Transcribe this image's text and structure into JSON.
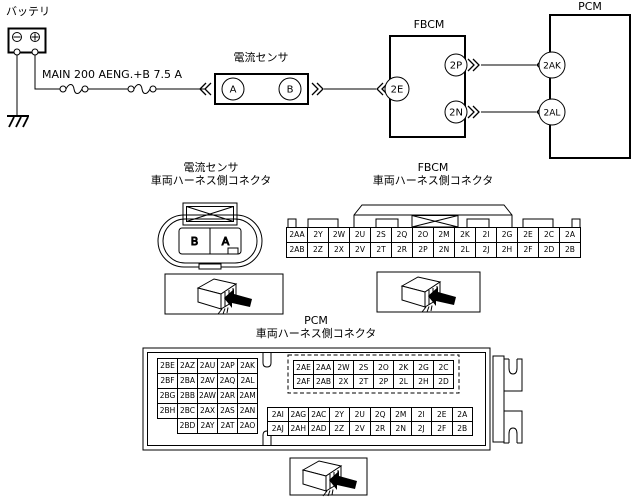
{
  "schematic": {
    "battery_label": "バッテリ",
    "fuse1_label": "MAIN 200 A",
    "fuse2_label": "ENG.+B 7.5 A",
    "sensor_label": "電流センサ",
    "fbcm_label": "FBCM",
    "pcm_label": "PCM",
    "terminals": {
      "sensor_a": "A",
      "sensor_b": "B",
      "fbcm_in": "2E",
      "fbcm_out_top": "2P",
      "fbcm_out_bottom": "2N",
      "pcm_top": "2AK",
      "pcm_bottom": "2AL"
    }
  },
  "sensor_connector": {
    "title1": "電流センサ",
    "title2": "車両ハーネス側コネクタ",
    "pin_left": "B",
    "pin_right": "A"
  },
  "fbcm_connector": {
    "title1": "FBCM",
    "title2": "車両ハーネス側コネクタ",
    "pins": [
      [
        "2AA",
        "2Y",
        "2W",
        "2U",
        "2S",
        "2Q",
        "2O",
        "2M",
        "2K",
        "2I",
        "2G",
        "2E",
        "2C",
        "2A"
      ],
      [
        "2AB",
        "2Z",
        "2X",
        "2V",
        "2T",
        "2R",
        "2P",
        "2N",
        "2L",
        "2J",
        "2H",
        "2F",
        "2D",
        "2B"
      ]
    ]
  },
  "pcm_connector": {
    "title1": "PCM",
    "title2": "車両ハーネス側コネクタ",
    "left_pins": [
      [
        "2BE",
        "2AZ",
        "2AU",
        "2AP",
        "2AK"
      ],
      [
        "2BF",
        "2BA",
        "2AV",
        "2AQ",
        "2AL"
      ],
      [
        "2BG",
        "2BB",
        "2AW",
        "2AR",
        "2AM"
      ],
      [
        "2BH",
        "2BC",
        "2AX",
        "2AS",
        "2AN"
      ],
      [
        "",
        "2BD",
        "2AY",
        "2AT",
        "2AO"
      ]
    ],
    "top_right_pins": [
      [
        "2AE",
        "2AA",
        "2W",
        "2S",
        "2O",
        "2K",
        "2G",
        "2C"
      ],
      [
        "2AF",
        "2AB",
        "2X",
        "2T",
        "2P",
        "2L",
        "2H",
        "2D"
      ]
    ],
    "bottom_right_pins": [
      [
        "2AI",
        "2AG",
        "2AC",
        "2Y",
        "2U",
        "2Q",
        "2M",
        "2I",
        "2E",
        "2A"
      ],
      [
        "2AJ",
        "2AH",
        "2AD",
        "2Z",
        "2V",
        "2R",
        "2N",
        "2J",
        "2F",
        "2B"
      ]
    ]
  }
}
